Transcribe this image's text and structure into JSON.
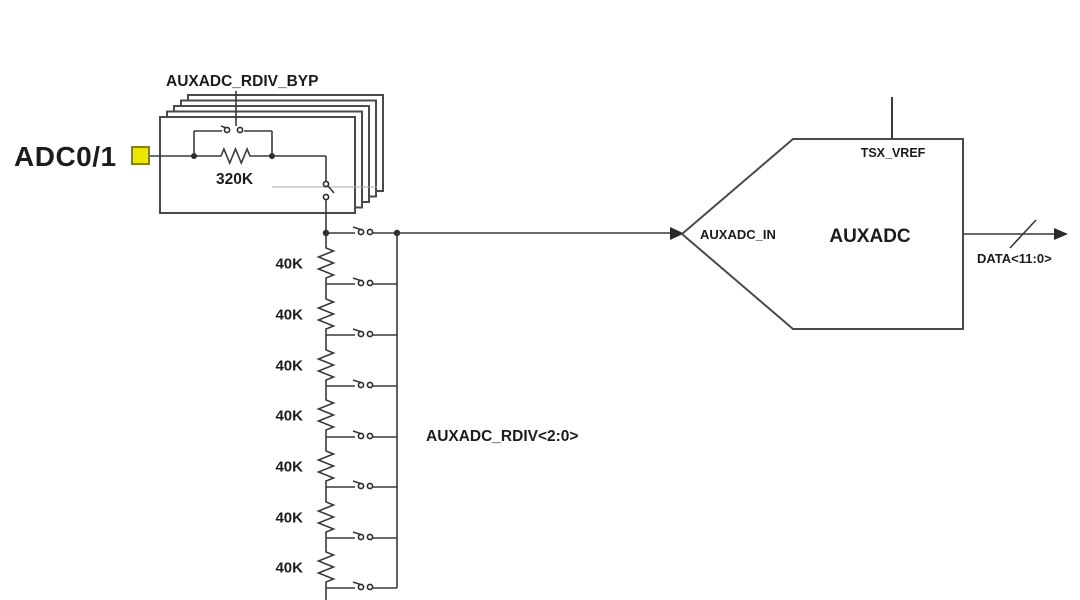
{
  "diagram": {
    "title": "AUXADC input resistive divider schematic",
    "input_pin": {
      "label": "ADC0/1"
    },
    "bypass_block": {
      "control_label": "AUXADC_RDIV_BYP",
      "resistor_value": "320K",
      "stack_count": 5
    },
    "ladder": {
      "control_label": "AUXADC_RDIV<2:0>",
      "resistors": [
        "40K",
        "40K",
        "40K",
        "40K",
        "40K",
        "40K",
        "40K"
      ]
    },
    "adc_block": {
      "name": "AUXADC",
      "input_label": "AUXADC_IN",
      "vref_label": "TSX_VREF",
      "output_label": "DATA<11:0>"
    },
    "colors": {
      "line": "#3a3a3a",
      "pad_fill": "#e9e702",
      "pad_border": "#83830a",
      "text": "#1c1c1c"
    }
  }
}
